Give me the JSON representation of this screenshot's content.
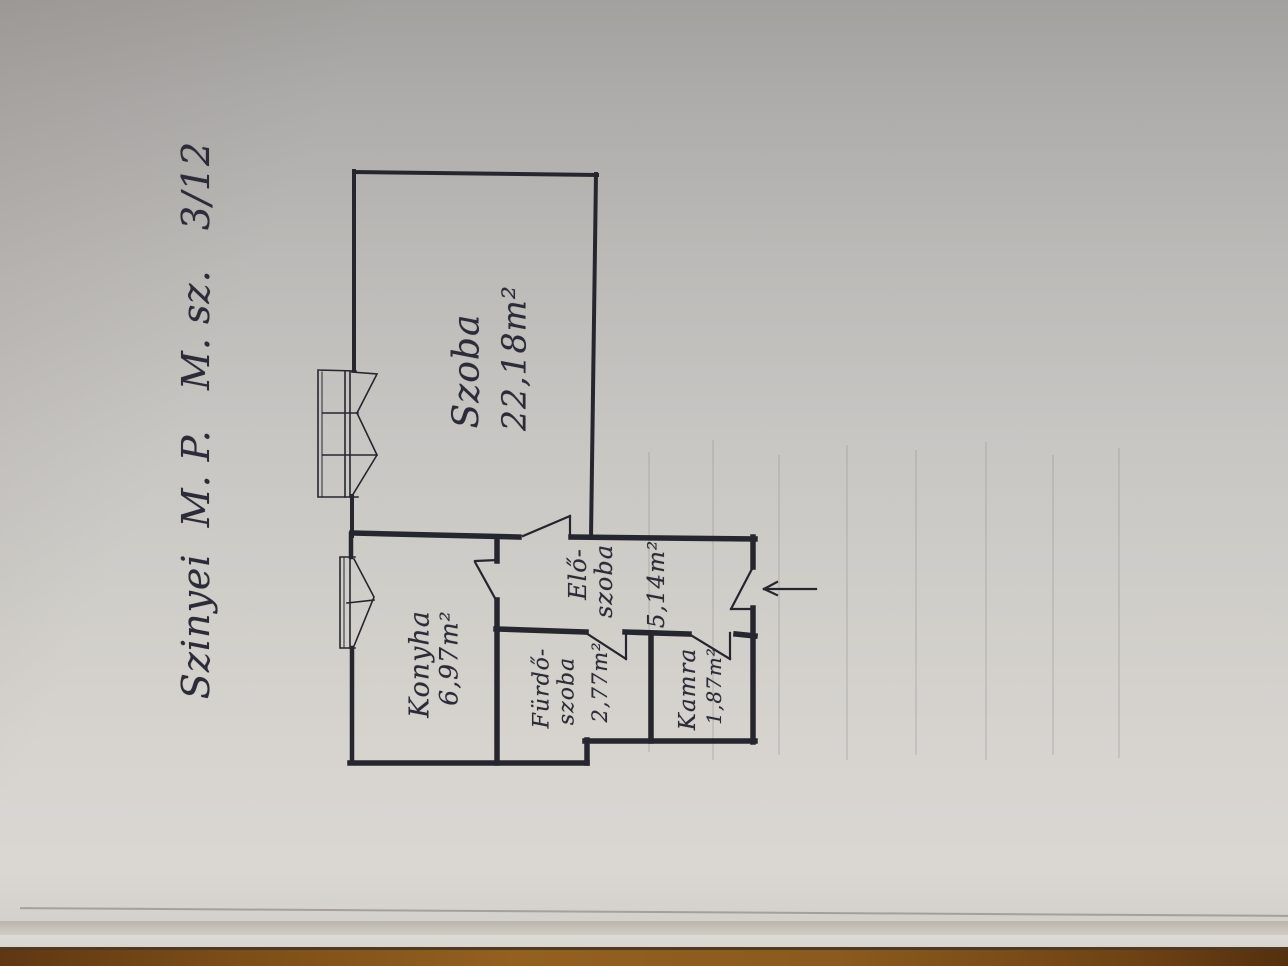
{
  "document": {
    "kind": "photographed hand-drawn apartment floor plan, drawing rotated 90 degrees",
    "title": "Szinyei  M. P.   M. sz.   3/12"
  },
  "plan": {
    "rooms": {
      "szoba": {
        "name": "Szoba",
        "area": "22,18m²"
      },
      "konyha": {
        "name": "Konyha",
        "area": "6,97m²"
      },
      "eloszoba": {
        "name_line1": "Elő-",
        "name_line2": "szoba",
        "area": "5,14m²"
      },
      "furdoszoba": {
        "name_line1": "Fürdő-",
        "name_line2": "szoba",
        "area": "2,77m²"
      },
      "kamra": {
        "name": "Kamra",
        "area": "1,87m²"
      }
    },
    "symbols": [
      "window",
      "door-swing",
      "entrance-arrow"
    ]
  },
  "colors": {
    "ink": "#26262f",
    "paper": "#c8c6c3",
    "table_wood": "#8a5a1e"
  }
}
